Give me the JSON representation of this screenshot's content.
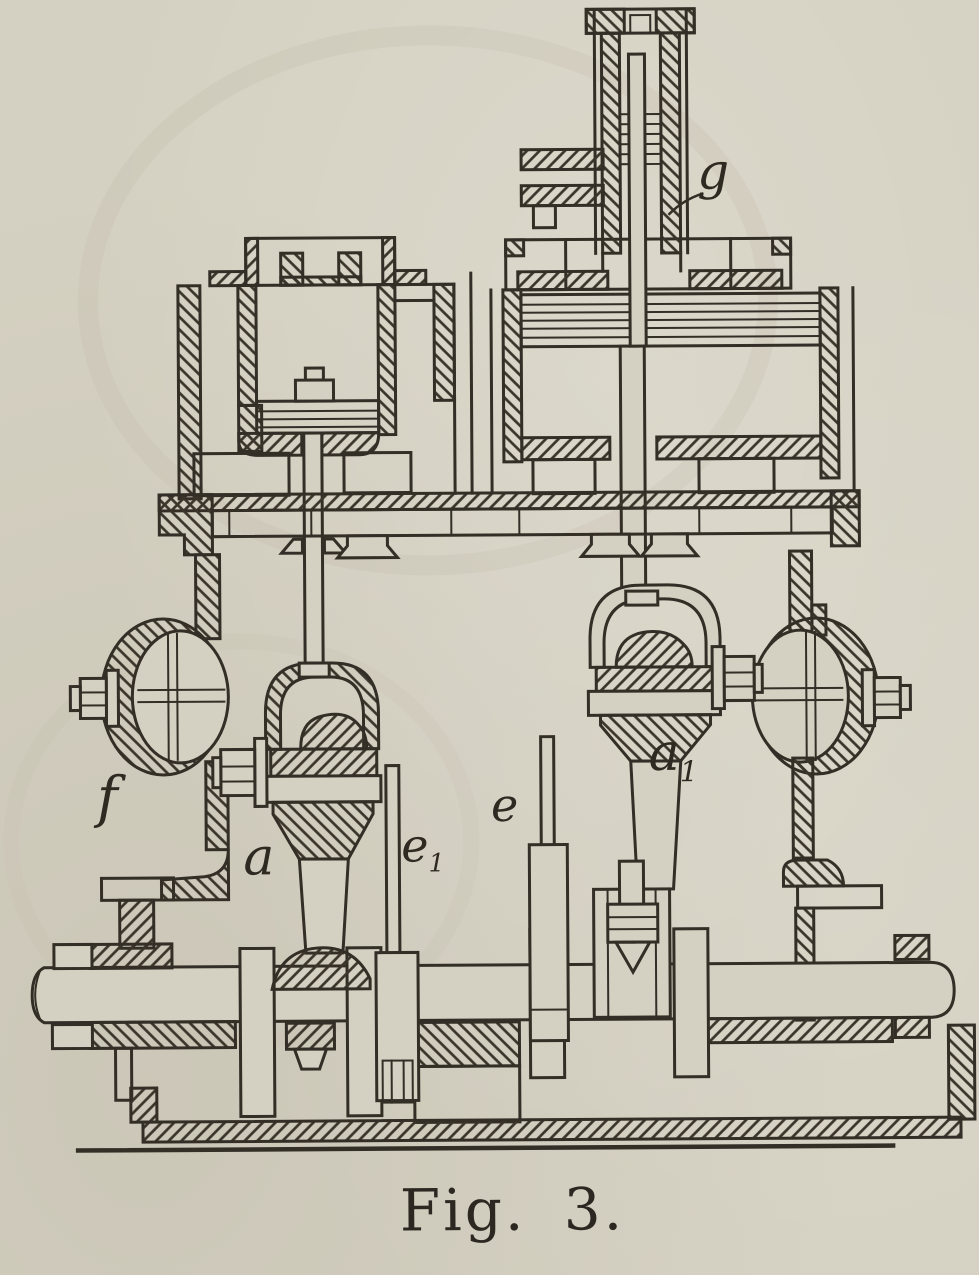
{
  "figure": {
    "caption": "Fig. 3.",
    "description": "Sectional engraving of a twin-cylinder engine with crankshaft, crossheads, balance weights and valve gear"
  },
  "labels": [
    {
      "id": "g",
      "base": "g",
      "sub": ""
    },
    {
      "id": "f",
      "base": "f",
      "sub": ""
    },
    {
      "id": "a",
      "base": "a",
      "sub": ""
    },
    {
      "id": "e1",
      "base": "e",
      "sub": "1"
    },
    {
      "id": "e",
      "base": "e",
      "sub": ""
    },
    {
      "id": "a1",
      "base": "a",
      "sub": "1"
    }
  ],
  "colors": {
    "paper": "#d5d1c2",
    "ink": "#332e26"
  }
}
